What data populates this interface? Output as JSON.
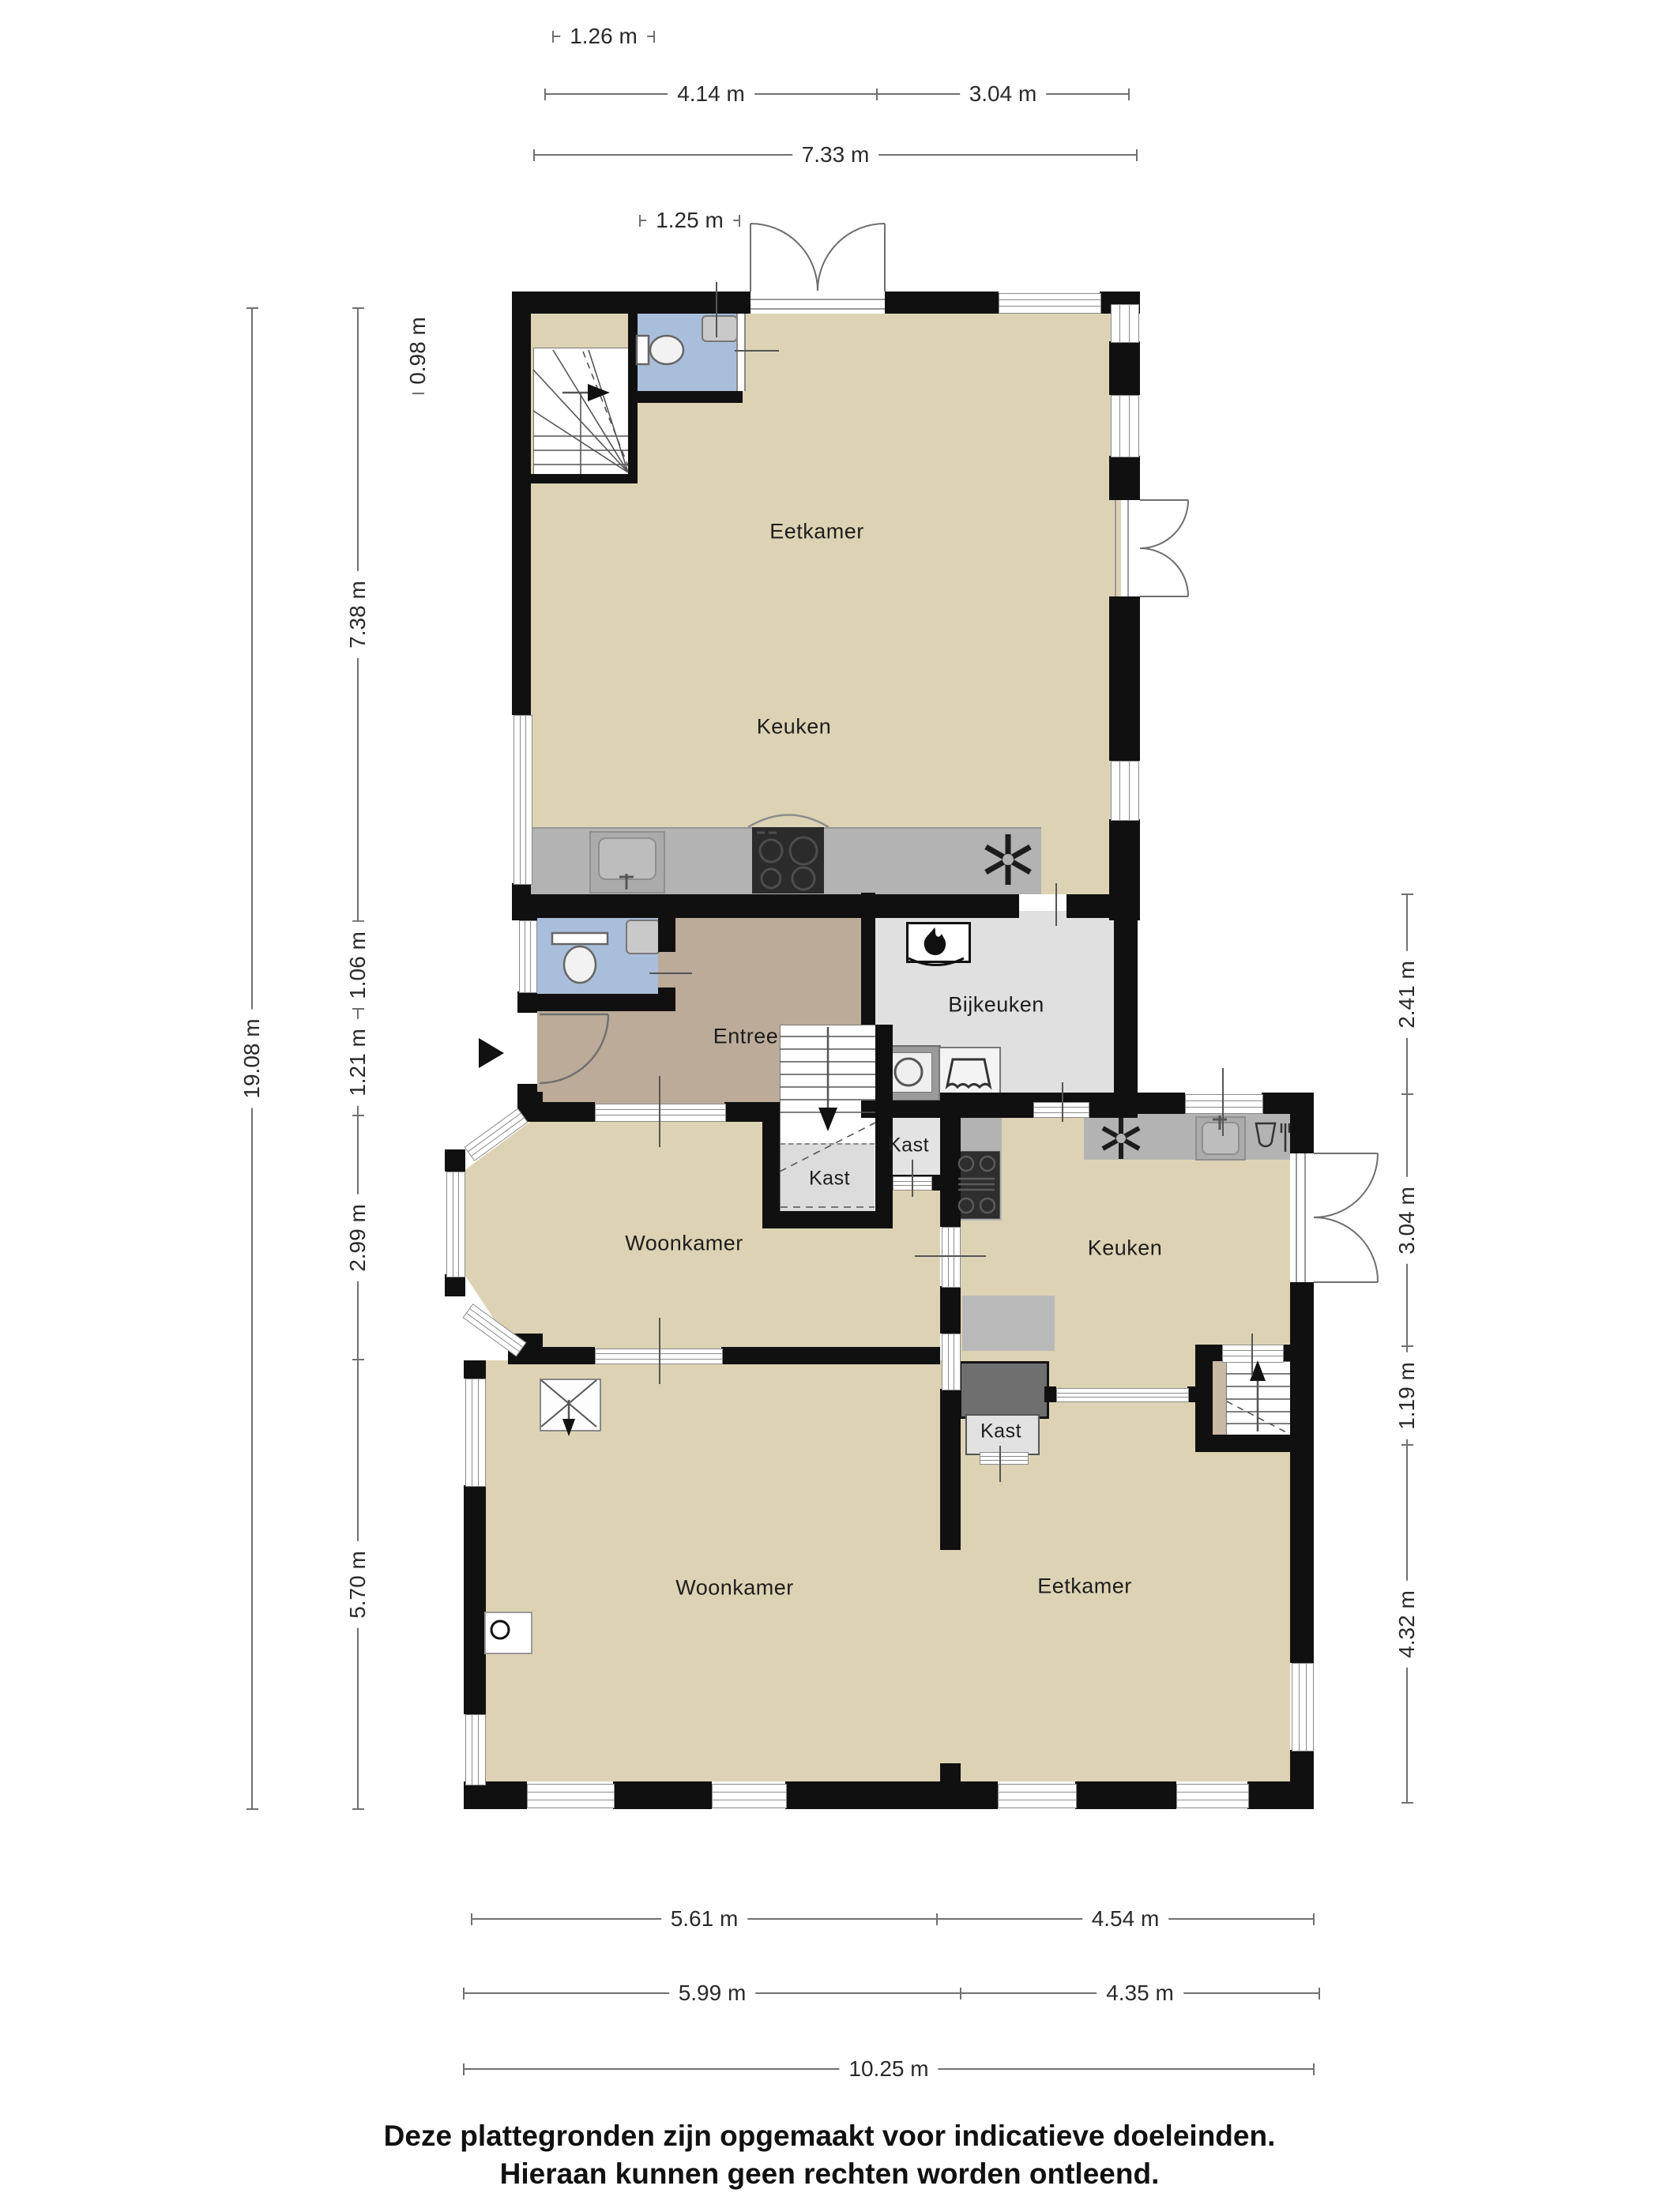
{
  "rooms": {
    "eetkamer_boven": "Eetkamer",
    "keuken_boven": "Keuken",
    "entree": "Entree",
    "bijkeuken": "Bijkeuken",
    "kast_onder_trap": "Kast",
    "kast_hal": "Kast",
    "woonkamer_midden": "Woonkamer",
    "keuken_beneden": "Keuken",
    "kast_eetkamer": "Kast",
    "woonkamer_beneden": "Woonkamer",
    "eetkamer_beneden": "Eetkamer"
  },
  "dimensions": {
    "top": [
      {
        "label": "1.26 m"
      },
      {
        "label": "4.14 m"
      },
      {
        "label": "3.04 m"
      },
      {
        "label": "7.33 m"
      },
      {
        "label": "1.25 m"
      }
    ],
    "bottom": [
      {
        "label": "5.61 m"
      },
      {
        "label": "4.54 m"
      },
      {
        "label": "5.99 m"
      },
      {
        "label": "4.35 m"
      },
      {
        "label": "10.25 m"
      }
    ],
    "left": [
      {
        "label": "19.08 m"
      },
      {
        "label": "7.38 m"
      },
      {
        "label": "1.06 m"
      },
      {
        "label": "1.21 m"
      },
      {
        "label": "2.99 m"
      },
      {
        "label": "5.70 m"
      },
      {
        "label": "0.98 m"
      }
    ],
    "right": [
      {
        "label": "2.41 m"
      },
      {
        "label": "3.04 m"
      },
      {
        "label": "1.19 m"
      },
      {
        "label": "4.32 m"
      }
    ]
  },
  "footer": {
    "line1": "Deze plattegronden zijn opgemaakt voor indicatieve doeleinden.",
    "line2": "Hieraan kunnen geen rechten worden ontleend."
  },
  "colors": {
    "floor_beige": "#ddd3b4",
    "floor_entree": "#bcab99",
    "floor_toilet_blue": "#a9bedb",
    "floor_utility_gray": "#e0e0e0",
    "counter_gray": "#b3b3b3",
    "stove_black": "#2b2b2b",
    "closet_dark_gray": "#6f6f6f",
    "wall_black": "#101010"
  },
  "icons": {
    "toilet": "toilet-icon",
    "sink": "sink-icon",
    "cooktop": "cooktop-icon",
    "extractor": "extractor-fan-icon",
    "boiler": "boiler-flame-icon",
    "washer": "washing-machine-icon",
    "dryer": "dryer-icon",
    "fireplace": "fireplace-icon",
    "stairs": "stairs-icon",
    "entrance_arrow": "entrance-arrow-icon",
    "chimney": "chimney-cross-icon"
  }
}
